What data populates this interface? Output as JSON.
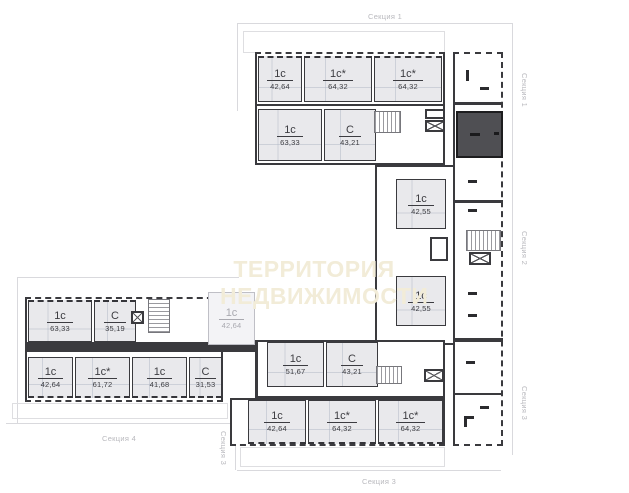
{
  "watermark": {
    "line1": "ТЕРРИТОРИЯ",
    "line2": "НЕДВИЖИМОСТИ"
  },
  "section_labels": {
    "top": "Секция 1",
    "right_section1": "Секция 1",
    "right_section2": "Секция 2",
    "right_section3": "Секция 3",
    "bottom_section3": "Секция 3",
    "left_section3": "Секция 3",
    "bottom_section4": "Секция 4"
  },
  "units": {
    "s1_top": [
      {
        "type": "1с",
        "area": "42,64"
      },
      {
        "type": "1с*",
        "area": "64,32"
      },
      {
        "type": "1с*",
        "area": "64,32"
      }
    ],
    "s1_inner": [
      {
        "type": "1с",
        "area": "63,33"
      },
      {
        "type": "С",
        "area": "43,21"
      }
    ],
    "s2": [
      {
        "type": "1с",
        "area": "42,55"
      },
      {
        "type": "1с",
        "area": "42,55"
      }
    ],
    "s3_inner": [
      {
        "type": "1с",
        "area": "51,67"
      },
      {
        "type": "С",
        "area": "43,21"
      }
    ],
    "s3_bottom": [
      {
        "type": "1с",
        "area": "42,64"
      },
      {
        "type": "1с*",
        "area": "64,32"
      },
      {
        "type": "1с*",
        "area": "64,32"
      }
    ],
    "s4_top": [
      {
        "type": "1с",
        "area": "63,33"
      },
      {
        "type": "С",
        "area": "35,19"
      },
      {
        "type": "1с",
        "area": "42,64"
      }
    ],
    "s4_bottom": [
      {
        "type": "1с",
        "area": "42,64"
      },
      {
        "type": "1с*",
        "area": "61,72"
      },
      {
        "type": "1с",
        "area": "41,68"
      },
      {
        "type": "С",
        "area": "31,53"
      }
    ]
  },
  "selected_unit": {
    "fill": "#4f4f53"
  },
  "colors": {
    "unit_fill": "#e9e9ec",
    "wall": "#3a3a3e",
    "dimension_line": "#d9d9dd",
    "unit_label_text": "#3c3c41",
    "section_label_text": "#b9b9be",
    "watermark_text": "#f2ecd8",
    "selected_fill": "#4f4f53"
  }
}
